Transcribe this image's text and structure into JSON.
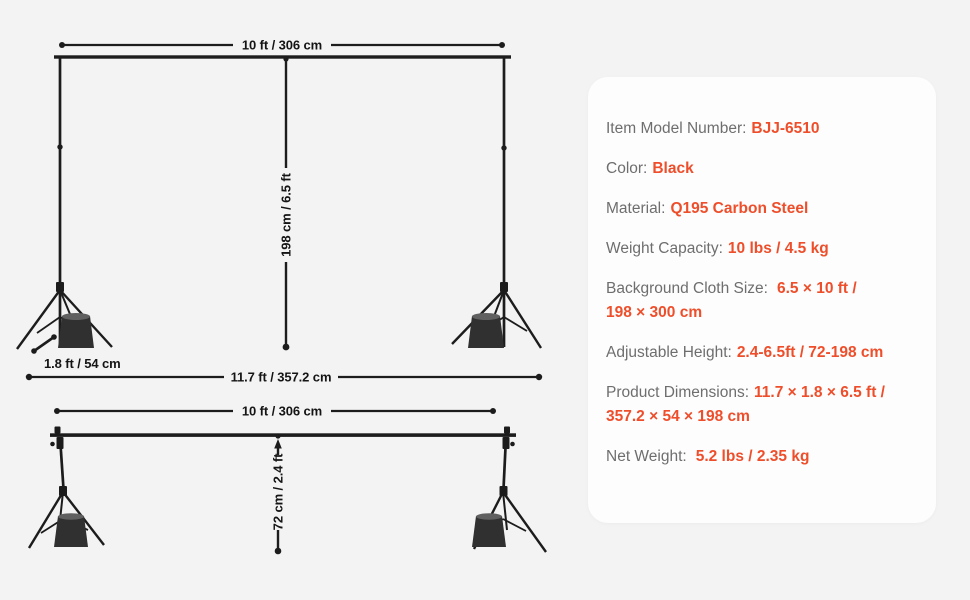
{
  "page": {
    "background": "#f3f3f3",
    "panel_background": "#fdfdfe",
    "accent_color": "#ee4e2a",
    "line_color": "#1c1c1c"
  },
  "diagrams": {
    "full_height": {
      "crossbar_width_label": "10 ft / 306 cm",
      "stand_height_label": "198 cm / 6.5 ft",
      "base_depth_label": "1.8 ft / 54 cm",
      "total_width_label": "11.7 ft / 357.2 cm"
    },
    "collapsed": {
      "crossbar_width_label": "10 ft / 306 cm",
      "min_height_label": "72 cm / 2.4 ft"
    }
  },
  "specs": [
    {
      "label": "Item Model Number:",
      "value": "BJJ-6510"
    },
    {
      "label": "Color:",
      "value": "Black"
    },
    {
      "label": "Material:",
      "value": "Q195 Carbon Steel"
    },
    {
      "label": "Weight Capacity:",
      "value": "10 lbs / 4.5 kg"
    },
    {
      "label": "Background Cloth Size:",
      "value": "6.5 × 10 ft /",
      "value2": "198 × 300 cm"
    },
    {
      "label": "Adjustable Height:",
      "value": "2.4-6.5ft / 72-198 cm"
    },
    {
      "label": "Product Dimensions:",
      "value": "11.7 × 1.8 × 6.5 ft /",
      "value2": "357.2 × 54 × 198 cm"
    },
    {
      "label": "Net Weight:",
      "value": "5.2 lbs / 2.35 kg"
    }
  ]
}
